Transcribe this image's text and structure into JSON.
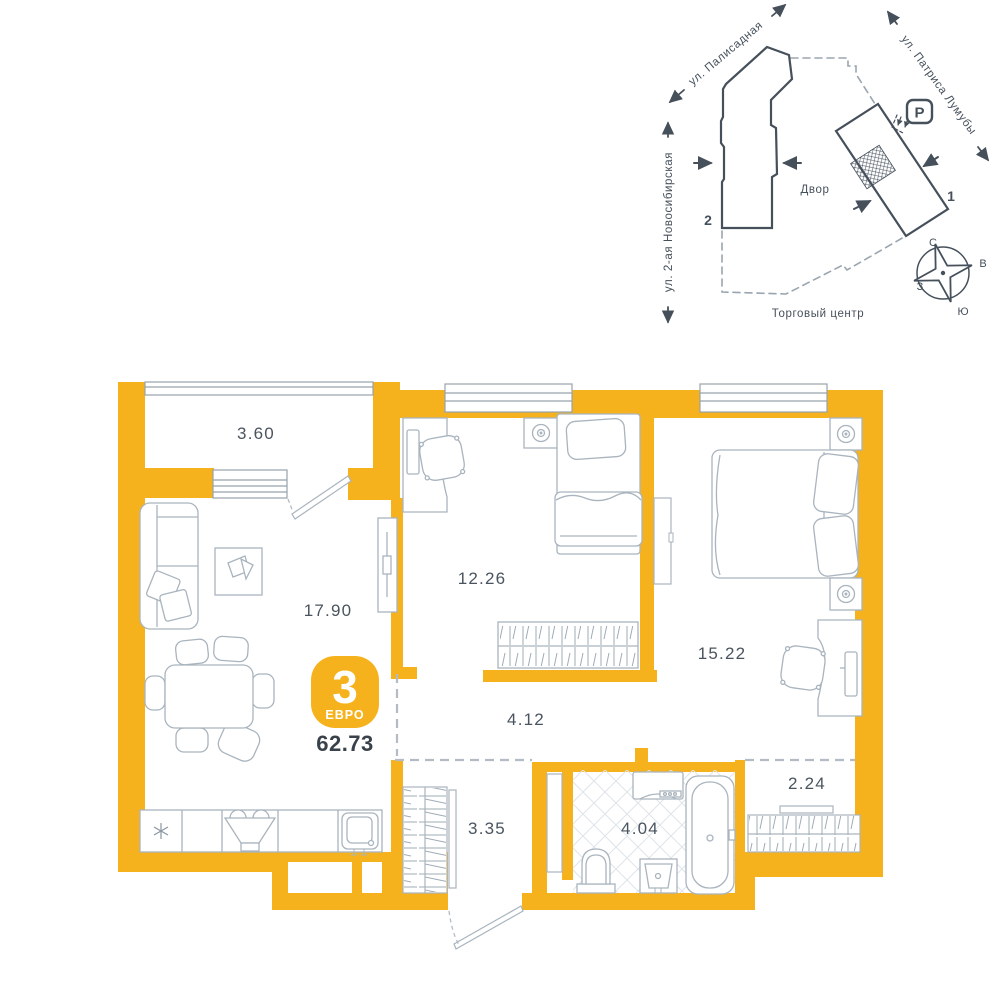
{
  "site_plan": {
    "street_top_left": "ул. Палисадная",
    "street_top_right": "ул. Патриса Лумубы",
    "street_left": "ул. 2-ая Новосибирская",
    "courtyard_label": "Двор",
    "shopping_center_label": "Торговый центр",
    "parking_label": "P",
    "building_1_label": "1",
    "building_2_label": "2",
    "compass": {
      "n": "С",
      "e": "В",
      "s": "Ю",
      "w": "З"
    }
  },
  "floor_plan": {
    "badge": {
      "rooms_count": "3",
      "layout_type": "ЕВРО",
      "total_area": "62.73"
    },
    "rooms": {
      "balcony": "3.60",
      "living_kitchen": "17.90",
      "bedroom_1": "12.26",
      "bedroom_2": "15.22",
      "hallway": "4.12",
      "entry_hall": "3.35",
      "bathroom": "4.04",
      "wardrobe": "2.24"
    }
  },
  "colors": {
    "wall_accent": "#F6B21C",
    "site_outline": "#46505B",
    "furniture_line": "#A9B4BE",
    "label_text": "#4A545E"
  }
}
